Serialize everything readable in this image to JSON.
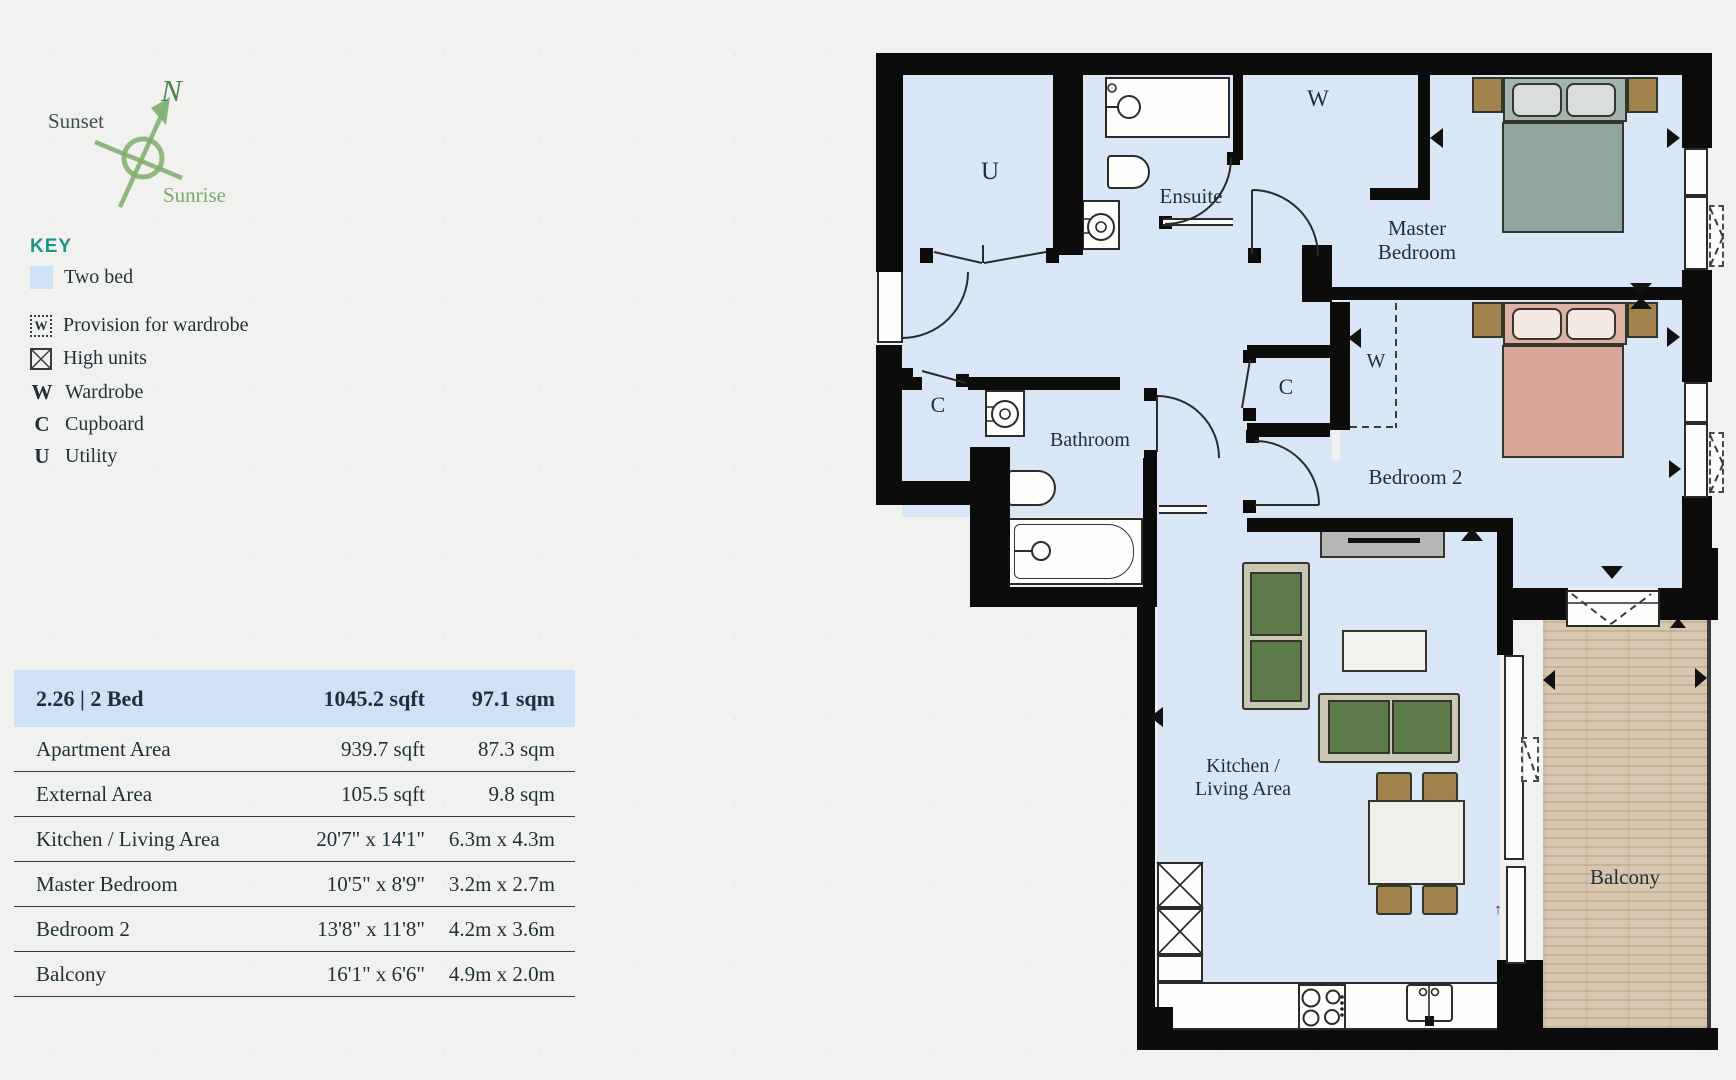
{
  "compass": {
    "north": "N",
    "sunset": "Sunset",
    "sunrise": "Sunrise"
  },
  "key": {
    "title": "KEY",
    "unit_swatch_label": "Two bed",
    "provision_symbol": "W",
    "provision_label": "Provision for wardrobe",
    "high_units_label": "High units",
    "wardrobe_symbol": "W",
    "wardrobe_label": "Wardrobe",
    "cupboard_symbol": "C",
    "cupboard_label": "Cupboard",
    "utility_symbol": "U",
    "utility_label": "Utility"
  },
  "table": {
    "header": {
      "unit": "2.26 | 2 Bed",
      "imperial": "1045.2 sqft",
      "metric": "97.1 sqm"
    },
    "rows": [
      {
        "label": "Apartment Area",
        "imperial": "939.7 sqft",
        "metric": "87.3 sqm"
      },
      {
        "label": "External Area",
        "imperial": "105.5 sqft",
        "metric": "9.8 sqm"
      },
      {
        "label": "Kitchen / Living Area",
        "imperial": "20'7\" x 14'1\"",
        "metric": "6.3m x 4.3m"
      },
      {
        "label": "Master Bedroom",
        "imperial": "10'5\" x 8'9\"",
        "metric": "3.2m x 2.7m"
      },
      {
        "label": "Bedroom 2",
        "imperial": "13'8\" x 11'8\"",
        "metric": "4.2m x 3.6m"
      },
      {
        "label": "Balcony",
        "imperial": "16'1\" x 6'6\"",
        "metric": "4.9m x 2.0m"
      }
    ]
  },
  "plan": {
    "labels": {
      "utility": "U",
      "ensuite": "Ensuite",
      "master_wardrobe": "W",
      "master_bedroom": "Master Bedroom",
      "bathroom": "Bathroom",
      "hall_cupboard": "C",
      "bedroom2_cupboard": "C",
      "bedroom2_wardrobe": "W",
      "bedroom2": "Bedroom 2",
      "kitchen_living": "Kitchen / Living Area",
      "balcony": "Balcony",
      "door_arrow": "↑"
    },
    "colors": {
      "room_fill": "#d9e6f6",
      "wall": "#0c0c0c",
      "balcony_wood": "#d9c8b1",
      "key_accent": "#1b9387",
      "table_header_bg": "#cfe1f4",
      "text": "#1f3038",
      "compass_green": "#82b173"
    }
  }
}
